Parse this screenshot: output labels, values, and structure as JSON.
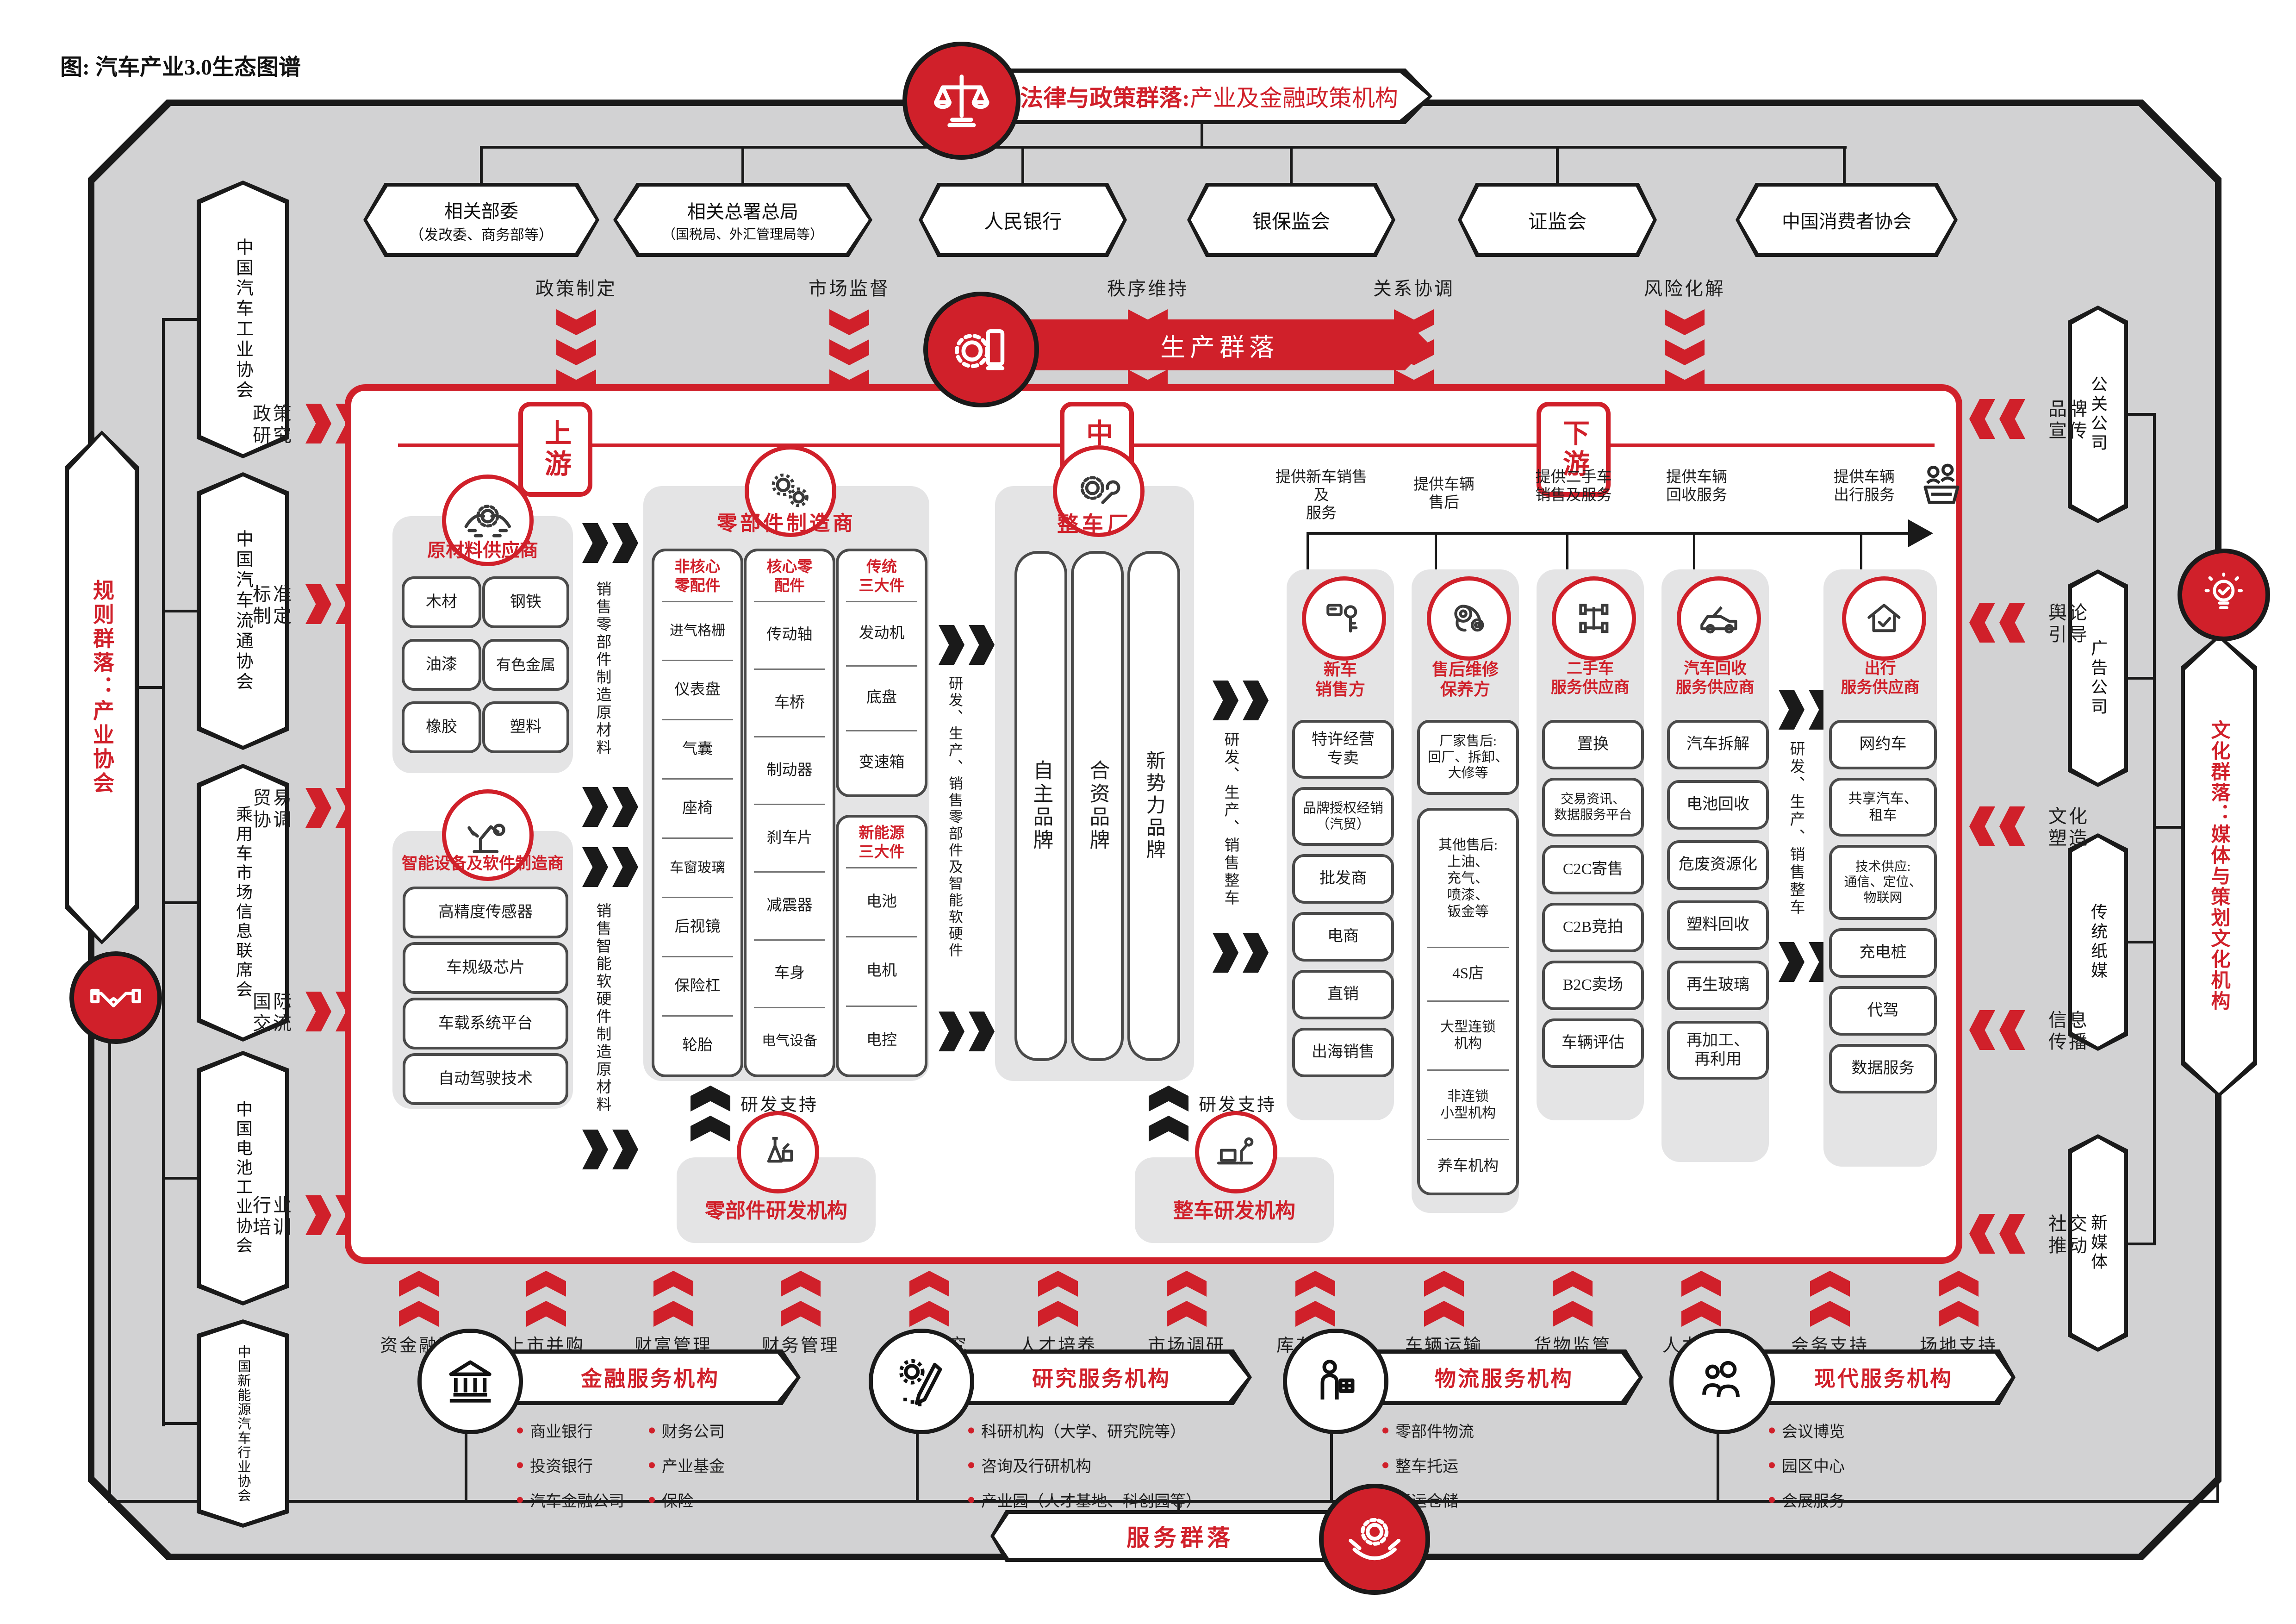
{
  "title": "图: 汽车产业3.0生态图谱",
  "colors": {
    "red": "#d0202a",
    "frame_gray": "#d2d2d3",
    "panel_gray": "#e4e4e5",
    "dark": "#1a1a1a"
  },
  "top": {
    "cluster_bold": "法律与政策群落:",
    "cluster_rest": " 产业及金融政策机构",
    "orgs": [
      {
        "l1": "相关部委",
        "l2": "（发改委、商务部等）"
      },
      {
        "l1": "相关总署总局",
        "l2": "（国税局、外汇管理局等）"
      },
      {
        "l1": "人民银行",
        "l2": ""
      },
      {
        "l1": "银保监会",
        "l2": ""
      },
      {
        "l1": "证监会",
        "l2": ""
      },
      {
        "l1": "中国消费者协会",
        "l2": ""
      }
    ],
    "funcs": [
      "政策制定",
      "市场监督",
      "秩序维持",
      "关系协调",
      "风险化解"
    ]
  },
  "left": {
    "banner": "规则群落：产业协会",
    "orgs": [
      "中国汽车工业协会",
      "中国汽车流通协会",
      "乘用车市场信息联席会",
      "中国电池工业协会",
      "中国新能源汽车行业协会"
    ],
    "funcs": [
      "政策\n研究",
      "标准\n制定",
      "贸易\n协调",
      "国际\n交流",
      "行业\n培训"
    ]
  },
  "right": {
    "banner": "文化群落：媒体与策划文化机构",
    "orgs": [
      "公关公司",
      "广告公司",
      "传统纸媒",
      "新媒体"
    ],
    "funcs": [
      "品牌\n宣传",
      "舆论\n引导",
      "文化\n塑造",
      "信息\n传播",
      "社交\n推动"
    ]
  },
  "prod": {
    "banner": "生产群落",
    "stages": [
      "上游",
      "中游",
      "下游"
    ],
    "rnd_support": "研发支持",
    "raw": {
      "title": "原材料供应商",
      "items": [
        "木材",
        "钢铁",
        "油漆",
        "有色金属",
        "橡胶",
        "塑料"
      ]
    },
    "flow_raw": "销售零部件制造原材料",
    "smart": {
      "title": "智能设备及软件制造商",
      "items": [
        "高精度传感器",
        "车规级芯片",
        "车载系统平台",
        "自动驾驶技术"
      ]
    },
    "flow_smart": "销售智能软硬件制造原材料",
    "parts": {
      "title": "零部件制造商",
      "flow": "研发、生产、销售零部件及智能软硬件",
      "rnd": "零部件研发机构",
      "cols": [
        {
          "h": "非核心\n零配件",
          "items": [
            "进气格栅",
            "仪表盘",
            "气囊",
            "座椅",
            "车窗玻璃",
            "后视镜",
            "保险杠",
            "轮胎"
          ]
        },
        {
          "h": "核心零\n配件",
          "items": [
            "传动轴",
            "车桥",
            "制动器",
            "刹车片",
            "减震器",
            "车身",
            "电气设备"
          ]
        },
        {
          "h": "传统\n三大件",
          "items": [
            "发动机",
            "底盘",
            "变速箱"
          ]
        },
        {
          "h": "新能源\n三大件",
          "items": [
            "电池",
            "电机",
            "电控"
          ]
        }
      ]
    },
    "oem": {
      "title": "整车厂",
      "brands": [
        "自主品牌",
        "合资品牌",
        "新势力品牌"
      ],
      "flow": "研发、生产、销售整车",
      "rnd": "整车研发机构"
    },
    "ds": {
      "ann": [
        "提供新车销售及\n服务",
        "提供车辆\n售后",
        "提供二手车\n销售及服务",
        "提供车辆\n回收服务",
        "提供车辆\n出行服务"
      ],
      "flow": "研发、生产、销售整车",
      "cols": [
        {
          "t": "新车\n销售方",
          "items": [
            "特许经营\n专卖",
            "品牌授权经销\n（汽贸）",
            "批发商",
            "电商",
            "直销",
            "出海销售"
          ]
        },
        {
          "t": "售后维修\n保养方",
          "pill": "厂家售后:\n回厂、拆卸、\n大修等",
          "group": [
            "其他售后:\n上油、\n充气、\n喷漆、\n钣金等",
            "4S店",
            "大型连锁\n机构",
            "非连锁\n小型机构",
            "养车机构"
          ]
        },
        {
          "t": "二手车\n服务供应商",
          "items": [
            "置换",
            "交易资讯、\n数据服务平台",
            "C2C寄售",
            "C2B竞拍",
            "B2C卖场",
            "车辆评估"
          ]
        },
        {
          "t": "汽车回收\n服务供应商",
          "items": [
            "汽车拆解",
            "电池回收",
            "危废资源化",
            "塑料回收",
            "再生玻璃",
            "再加工、\n再利用"
          ]
        },
        {
          "t": "出行\n服务供应商",
          "items": [
            "网约车",
            "共享汽车、\n租车",
            "技术供应:\n通信、定位、\n物联网",
            "充电桩",
            "代驾",
            "数据服务"
          ]
        }
      ]
    }
  },
  "svc": {
    "banner": "服务群落",
    "funcs": [
      "资金融通",
      "上市并购",
      "财富管理",
      "财务管理",
      "科学研究",
      "人才培养",
      "市场调研",
      "库存管理",
      "车辆运输",
      "货物监管",
      "人力支持",
      "会务支持",
      "场地支持"
    ],
    "groups": [
      {
        "t": "金融服务机构",
        "b1": [
          "商业银行",
          "投资银行",
          "汽车金融公司"
        ],
        "b2": [
          "财务公司",
          "产业基金",
          "保险"
        ]
      },
      {
        "t": "研究服务机构",
        "b1": [
          "科研机构（大学、研究院等）",
          "咨询及行研机构",
          "产业园（人才基地、科创园等）"
        ],
        "b2": []
      },
      {
        "t": "物流服务机构",
        "b1": [
          "零部件物流",
          "整车托运",
          "货运仓储"
        ],
        "b2": []
      },
      {
        "t": "现代服务机构",
        "b1": [
          "会议博览",
          "园区中心",
          "会展服务"
        ],
        "b2": []
      }
    ]
  }
}
